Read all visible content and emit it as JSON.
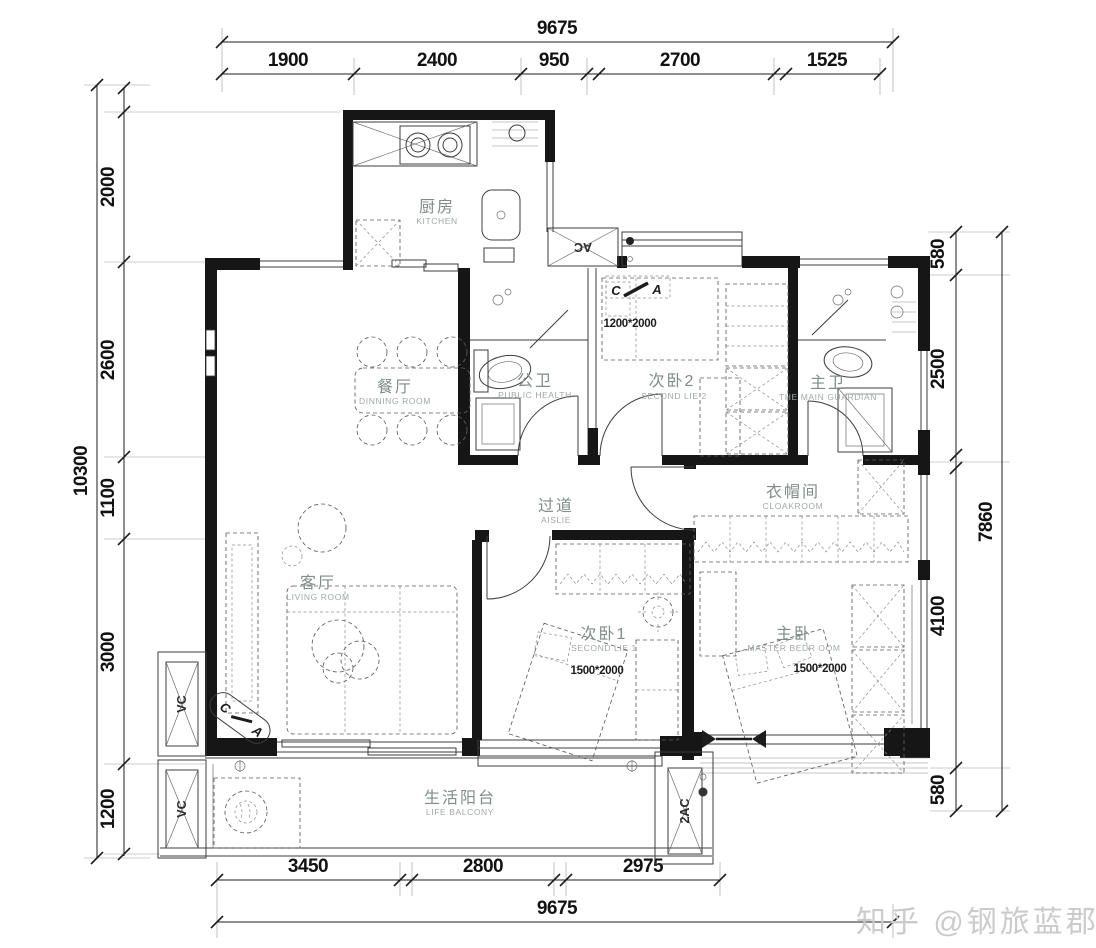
{
  "dims": {
    "top": {
      "total": "9675",
      "segments": [
        "1900",
        "2400",
        "950",
        "2700",
        "1525"
      ]
    },
    "bottom": {
      "total": "9675",
      "segments": [
        "3450",
        "2800",
        "2975"
      ]
    },
    "left": {
      "total": "10300",
      "segments": [
        "2000",
        "2600",
        "1100",
        "3000",
        "1200"
      ]
    },
    "right": {
      "total": "7860",
      "segments": [
        "580",
        "2500",
        "4100",
        "580"
      ]
    }
  },
  "rooms": {
    "kitchen": {
      "zh": "厨房",
      "en": "KITCHEN"
    },
    "dining": {
      "zh": "餐厅",
      "en": "DINNING ROOM"
    },
    "public_bath": {
      "zh": "公卫",
      "en": "PUBLIC HEALTH"
    },
    "bedroom2": {
      "zh": "次卧2",
      "en": "SECOND LIE 2",
      "bed": "1200*2000"
    },
    "master_bath": {
      "zh": "主卫",
      "en": "THE MAIN GUARDIAN"
    },
    "aisle": {
      "zh": "过道",
      "en": "AISLIE"
    },
    "cloakroom": {
      "zh": "衣帽间",
      "en": "CLOAKROOM"
    },
    "living": {
      "zh": "客厅",
      "en": "LIVING ROOM"
    },
    "bedroom1": {
      "zh": "次卧1",
      "en": "SECOND LIE 1",
      "bed": "1500*2000"
    },
    "master_bedroom": {
      "zh": "主卧",
      "en": "MASTER BEDR OOM",
      "bed": "1500*2000"
    },
    "balcony": {
      "zh": "生活阳台",
      "en": "LIFE BALCONY"
    }
  },
  "shafts": {
    "kitchen_ac": "AC",
    "vent_upper": "VC",
    "vent_lower": "VC",
    "balcony_ac": "2AC"
  },
  "markers": {
    "m1": {
      "c": "C",
      "a": "A"
    },
    "m2": {
      "c": "C",
      "a": "A"
    }
  },
  "watermark": {
    "text": "知乎 @钢旅蓝郡业主"
  },
  "colors": {
    "wall": "#161616",
    "label": "#7e8d8a",
    "dimension": "#1d1d1d",
    "watermark": "#cbcbcb"
  }
}
